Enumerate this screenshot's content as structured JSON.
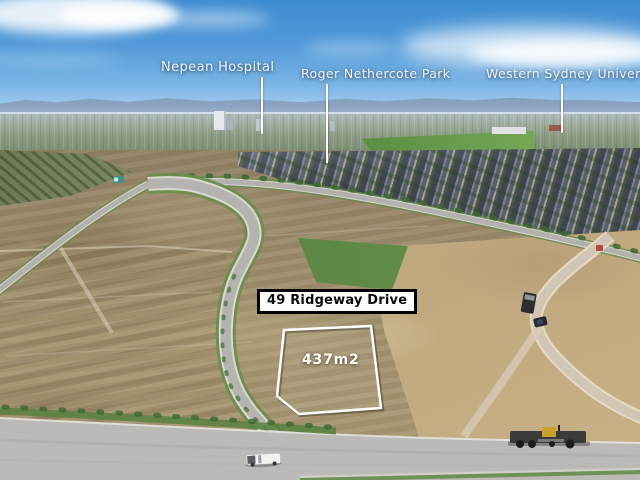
{
  "landmark_labels": {
    "nepean": "Nepean Hospital",
    "roger_park": "Roger Nethercote Park",
    "university": "Western Sydney University"
  },
  "lot": {
    "address": "49 Ridgeway Drive",
    "area": "437m2"
  },
  "colors": {
    "sky_top": "#3d8bd0",
    "sky_horizon": "#cae5f5",
    "mountains": "#8099ba",
    "dirt": "#9c8c6a",
    "sand": "#c4ad84",
    "road_asphalt": "#b5b3b0",
    "grass_verge": "#688e4a",
    "label_text": "#eef3f8",
    "address_bg": "#ffffff",
    "address_border": "#000000",
    "lot_outline": "#ffffff"
  }
}
